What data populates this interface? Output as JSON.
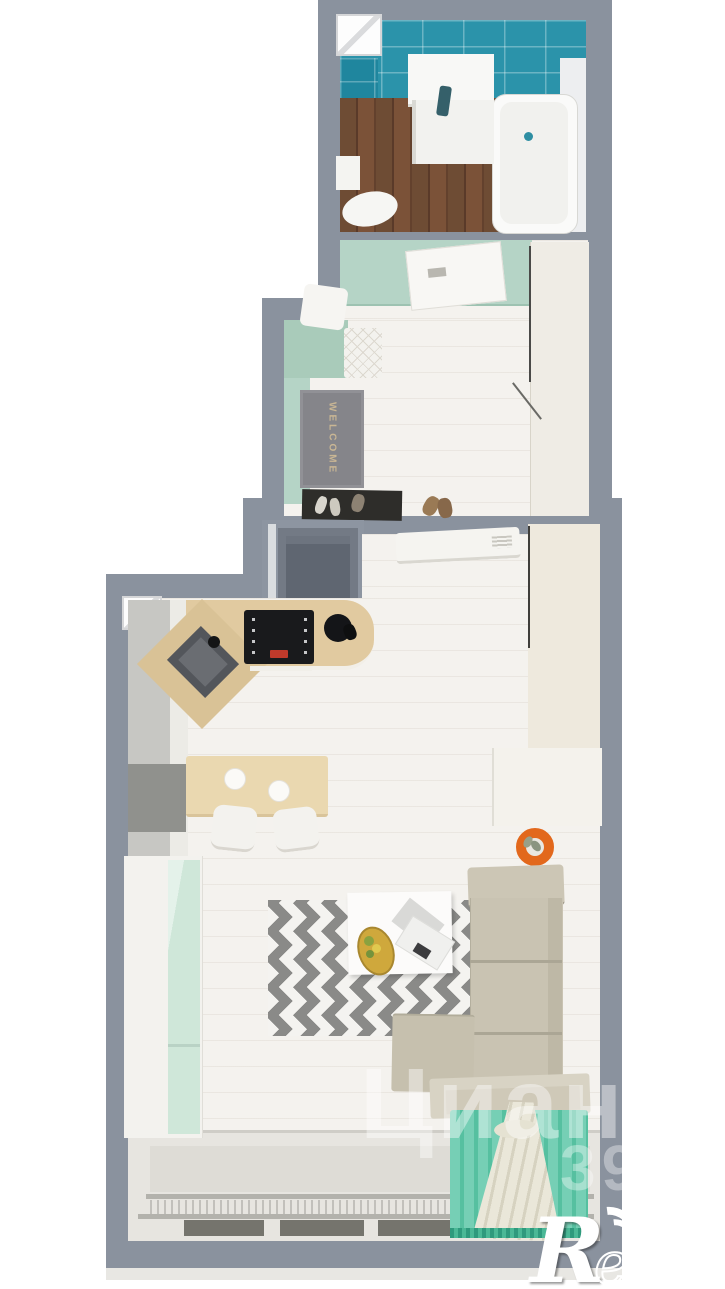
{
  "scene": {
    "type": "apartment-3d-floor-plan-render",
    "rooms": [
      "bathroom",
      "hallway",
      "living-room-with-kitchen"
    ]
  },
  "bathroom": {
    "fixtures": [
      "teal-tiled-walls",
      "dark-wood-floor",
      "bathtub",
      "sink-vanity",
      "toilet",
      "small-window"
    ]
  },
  "hallway": {
    "welcome_mat_text": "WELCOME",
    "fixtures": [
      "mint-walls",
      "open-bathroom-door",
      "wardrobe",
      "tufted-bench",
      "shoe-mat",
      "entry-door-niche"
    ]
  },
  "living_kitchen": {
    "fixtures": [
      "kitchen-cabinets",
      "induction-cooktop",
      "round-sink",
      "corner-sink",
      "bar-table",
      "bar-stools",
      "fridge",
      "tall-cabinet-mint",
      "wardrobe",
      "air-conditioner",
      "sofa",
      "chaise",
      "coffee-table",
      "fruit-plate",
      "magazines",
      "chevron-rug",
      "orange-planter",
      "cornice",
      "teal-curtain",
      "white-tied-curtain",
      "panoramic-window",
      "radiator",
      "left-wall-window"
    ]
  },
  "watermark_cian": {
    "text": "Циан",
    "digits": "39"
  },
  "logo_restate": {
    "initial": "R",
    "rest": "estate"
  },
  "palette": {
    "wall_gray": "#8a929e",
    "tile_teal": "#2b93aa",
    "mint_wall": "#b5d4c6",
    "bath_floor_brown": "#6a4a34",
    "kitchen_wood": "#e1caa0",
    "sofa_beige": "#c9c3b2",
    "rug_gray": "#8a8a88",
    "curtain_teal": "#64c8ab",
    "accent_orange": "#e2681c",
    "floor_white": "#f4f2ee"
  }
}
